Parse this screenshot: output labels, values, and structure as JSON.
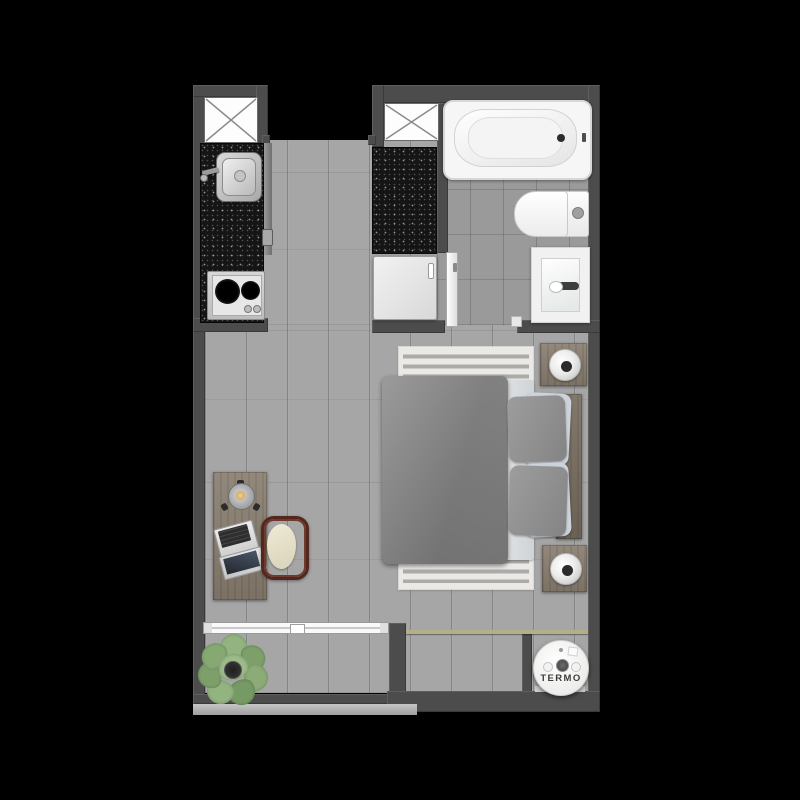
{
  "meta": {
    "title": "Studio apartment floor plan (top-down 3D render)"
  },
  "labels": {
    "water_heater": "TERMO"
  },
  "palette": {
    "background": "#000000",
    "wall": "#4c4c4c",
    "plank_floor": "#a6a6a6",
    "tile_floor": "#9a9a9a",
    "countertop": "#151515",
    "wood": "#897e70",
    "fixture_white": "#f4f4f4",
    "duvet_gray": "#8c8c8c",
    "pillow_blue_gray": "#ccd3da",
    "chair_frame": "#51271f",
    "plant_green": "#8aab78",
    "glass_partition": "#b3af87"
  },
  "rooms": [
    {
      "name": "kitchen-galley"
    },
    {
      "name": "entry-hallway"
    },
    {
      "name": "bathroom"
    },
    {
      "name": "living-bedroom"
    },
    {
      "name": "balcony"
    },
    {
      "name": "water-heater-niche"
    }
  ],
  "fixtures": [
    {
      "name": "ventilation-shaft-kitchen",
      "symbol": "crossed-box"
    },
    {
      "name": "ventilation-shaft-bathroom",
      "symbol": "crossed-box"
    },
    {
      "name": "kitchen-sink"
    },
    {
      "name": "two-burner-stove"
    },
    {
      "name": "under-counter-appliance"
    },
    {
      "name": "bathtub"
    },
    {
      "name": "toilet"
    },
    {
      "name": "bathroom-vanity-sink"
    },
    {
      "name": "bathroom-door"
    },
    {
      "name": "double-bed"
    },
    {
      "name": "area-rug"
    },
    {
      "name": "nightstand",
      "count": 2
    },
    {
      "name": "table-lamp",
      "count": 2
    },
    {
      "name": "desk"
    },
    {
      "name": "desk-lamp"
    },
    {
      "name": "laptop"
    },
    {
      "name": "desk-chair"
    },
    {
      "name": "sliding-window"
    },
    {
      "name": "potted-plant"
    },
    {
      "name": "glass-partition"
    },
    {
      "name": "water-heater",
      "label_key": "labels.water_heater"
    }
  ]
}
